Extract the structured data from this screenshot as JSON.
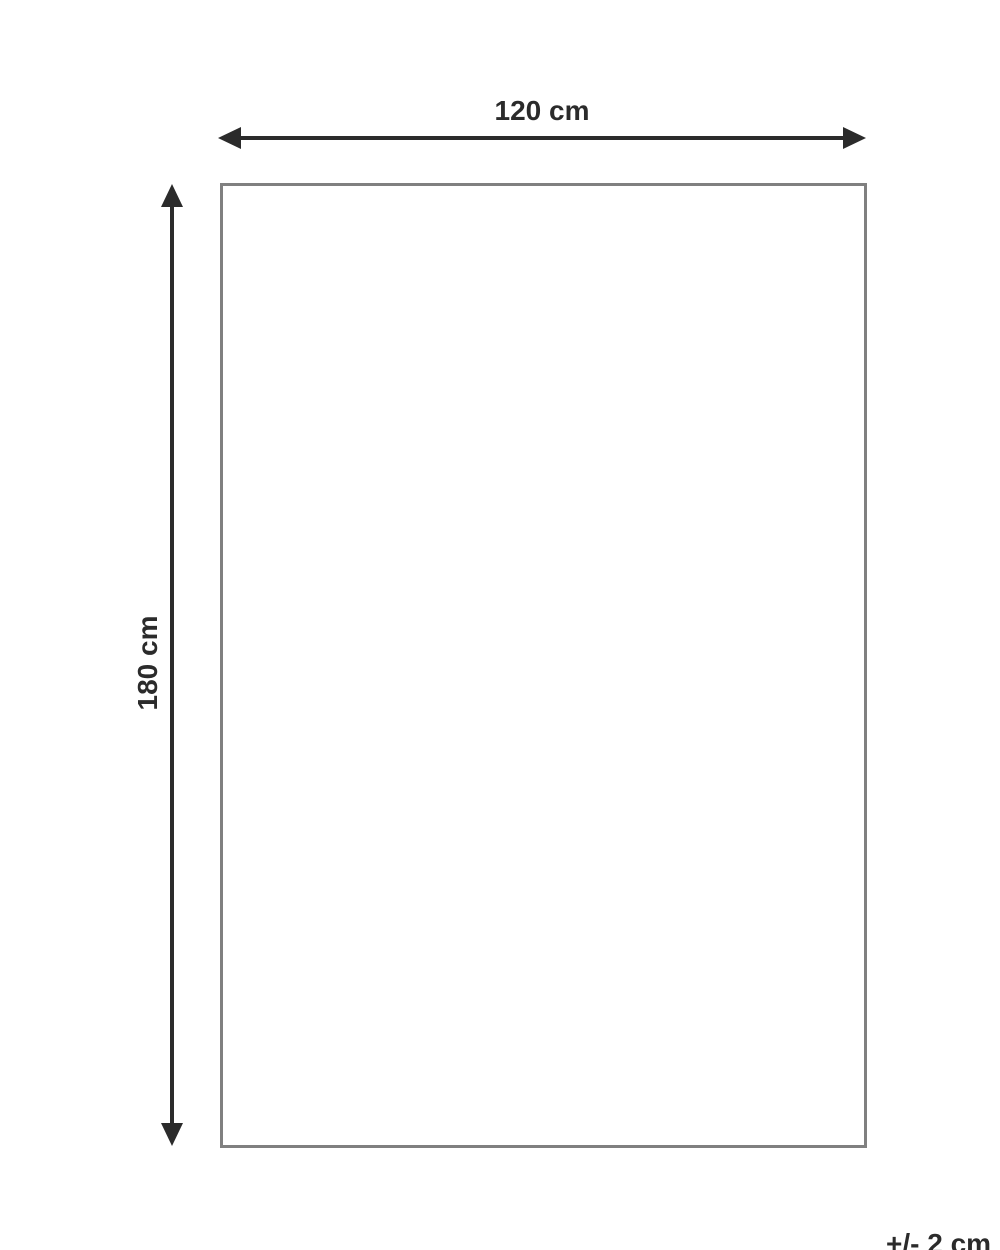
{
  "diagram": {
    "type": "product-dimension-diagram",
    "width_label": "120 cm",
    "height_label": "180 cm",
    "tolerance_label": "+/- 2 cm",
    "colors": {
      "arrow": "#2b2b2b",
      "text": "#2b2b2b",
      "rect_border": "#808080",
      "background": "#ffffff"
    }
  }
}
